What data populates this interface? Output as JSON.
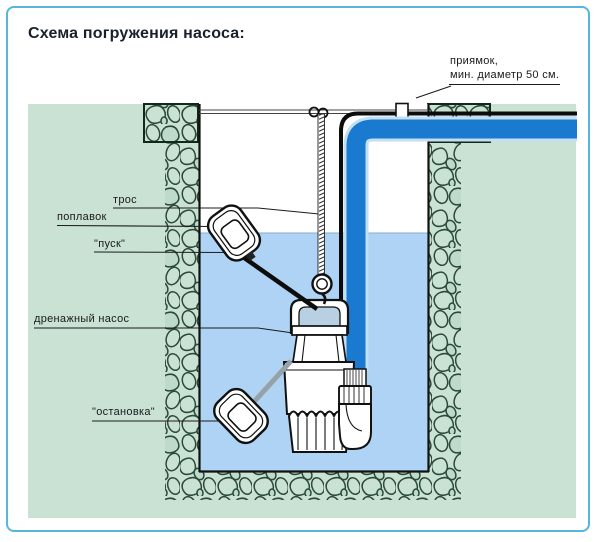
{
  "title": "Схема погружения насоса:",
  "labels": {
    "pit_line1": "приямок,",
    "pit_line2": "мин. диаметр 50 см.",
    "rope": "трос",
    "float": "поплавок",
    "start": "\"пуск\"",
    "pump": "дренажный насос",
    "stop": "\"остановка\""
  },
  "colors": {
    "accent_border": "#57b6e0",
    "ground_green": "#cae2d4",
    "stone_outline": "#2c4a38",
    "water": "#aed3f5",
    "pipe_blue": "#1a7ad0",
    "pipe_halo": "#c3dff2",
    "line_black": "#111111",
    "cable_gray": "#97a1a8",
    "title_color": "#18202b"
  }
}
